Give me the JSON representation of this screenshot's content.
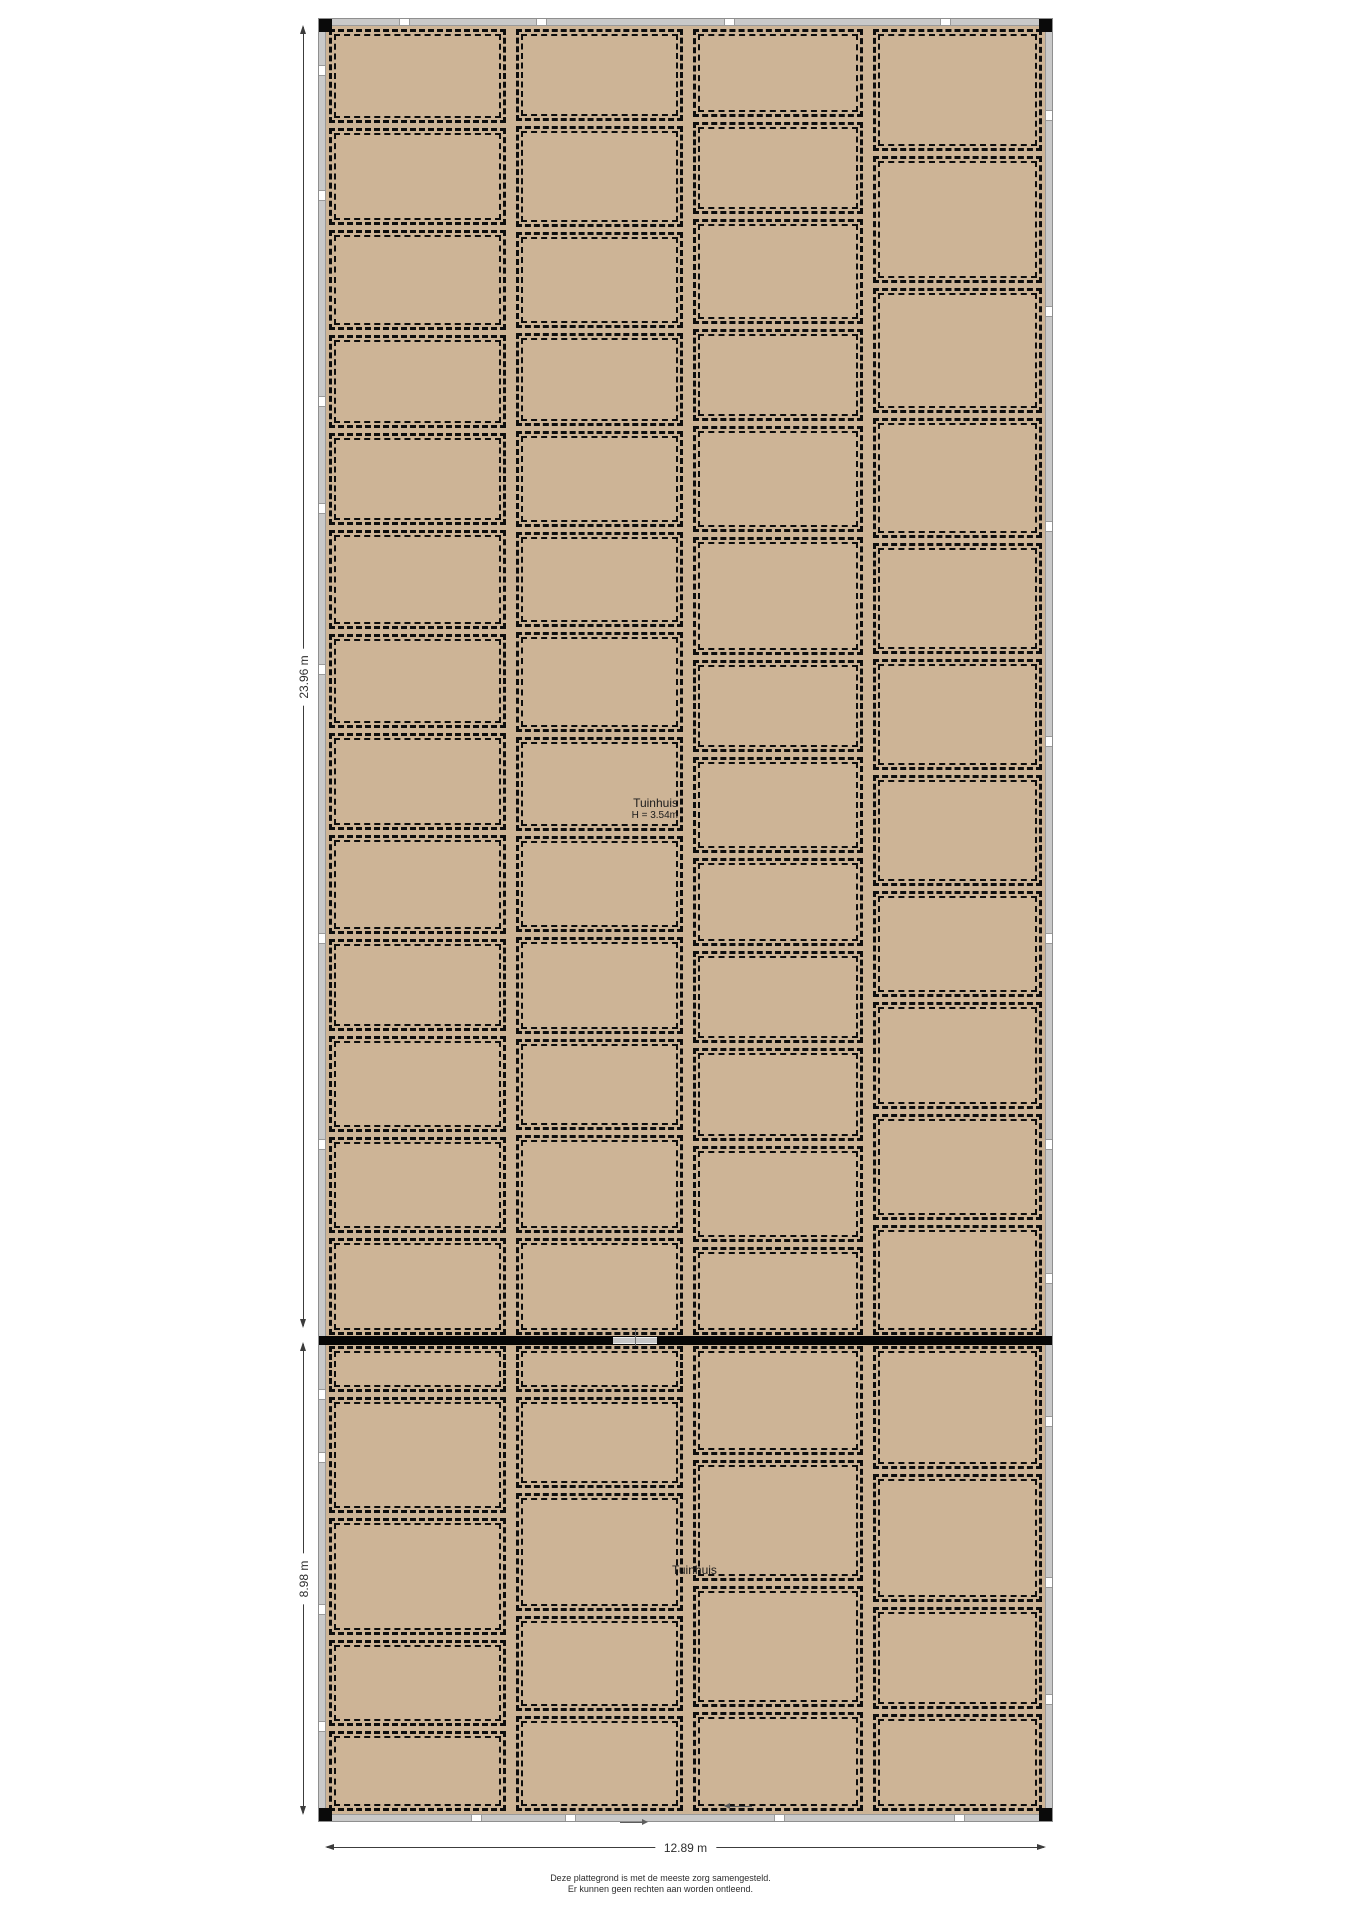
{
  "plan": {
    "labels": {
      "tuinhuis_boven_line1": "Tuinhuis",
      "tuinhuis_boven_line2": "H = 3.54m",
      "tuinhuis_onder": "Tuinhuis"
    },
    "dimensions": {
      "left_upper": "23.96 m",
      "left_lower": "8.98 m",
      "bottom": "12.89 m"
    },
    "footer": {
      "line1": "Deze plattegrond is met de meeste zorg samengesteld.",
      "line2": "Er kunnen geen rechten aan worden ontleend."
    },
    "colors": {
      "cell_fill": "#cdb496",
      "wall_gray": "#c9c9c9",
      "dash_black": "#0d0d0d"
    },
    "grid": {
      "top": {
        "columns": [
          {
            "w": 0.259,
            "cells": [
              98,
              102,
              105,
              97,
              96,
              104,
              98,
              102,
              103,
              97,
              100,
              100,
              102
            ]
          },
          {
            "w": 0.244,
            "cells": [
              96,
              106,
              101,
              97,
              100,
              100,
              105,
              98,
              100,
              102,
              95,
              103,
              101
            ]
          },
          {
            "w": 0.25,
            "cells": [
              95,
              100,
              115,
              100,
              115,
              130,
              100,
              105,
              95,
              100,
              100,
              105,
              95
            ]
          },
          {
            "w": 0.247,
            "cells": [
              127,
              133,
              130,
              125,
              115,
              115,
              115,
              110,
              110,
              110,
              114
            ]
          }
        ]
      },
      "bottom": {
        "columns": [
          {
            "w": 0.259,
            "cells": [
              45,
              123,
              124,
              90,
              83
            ]
          },
          {
            "w": 0.244,
            "cells": [
              45,
              95,
              125,
              100,
              100
            ]
          },
          {
            "w": 0.25,
            "cells": [
              113,
              125,
              125,
              102
            ]
          },
          {
            "w": 0.247,
            "cells": [
              128,
              133,
              105,
              99
            ]
          }
        ]
      }
    },
    "wall_ticks": {
      "left": [
        0.025,
        0.095,
        0.21,
        0.27,
        0.36,
        0.51,
        0.625,
        0.765,
        0.8,
        0.885,
        0.95
      ],
      "top": [
        0.11,
        0.3,
        0.56,
        0.86
      ],
      "right": [
        0.05,
        0.16,
        0.28,
        0.4,
        0.51,
        0.625,
        0.7,
        0.78,
        0.87,
        0.935
      ],
      "bottom": [
        0.21,
        0.34,
        0.63,
        0.88
      ]
    }
  }
}
